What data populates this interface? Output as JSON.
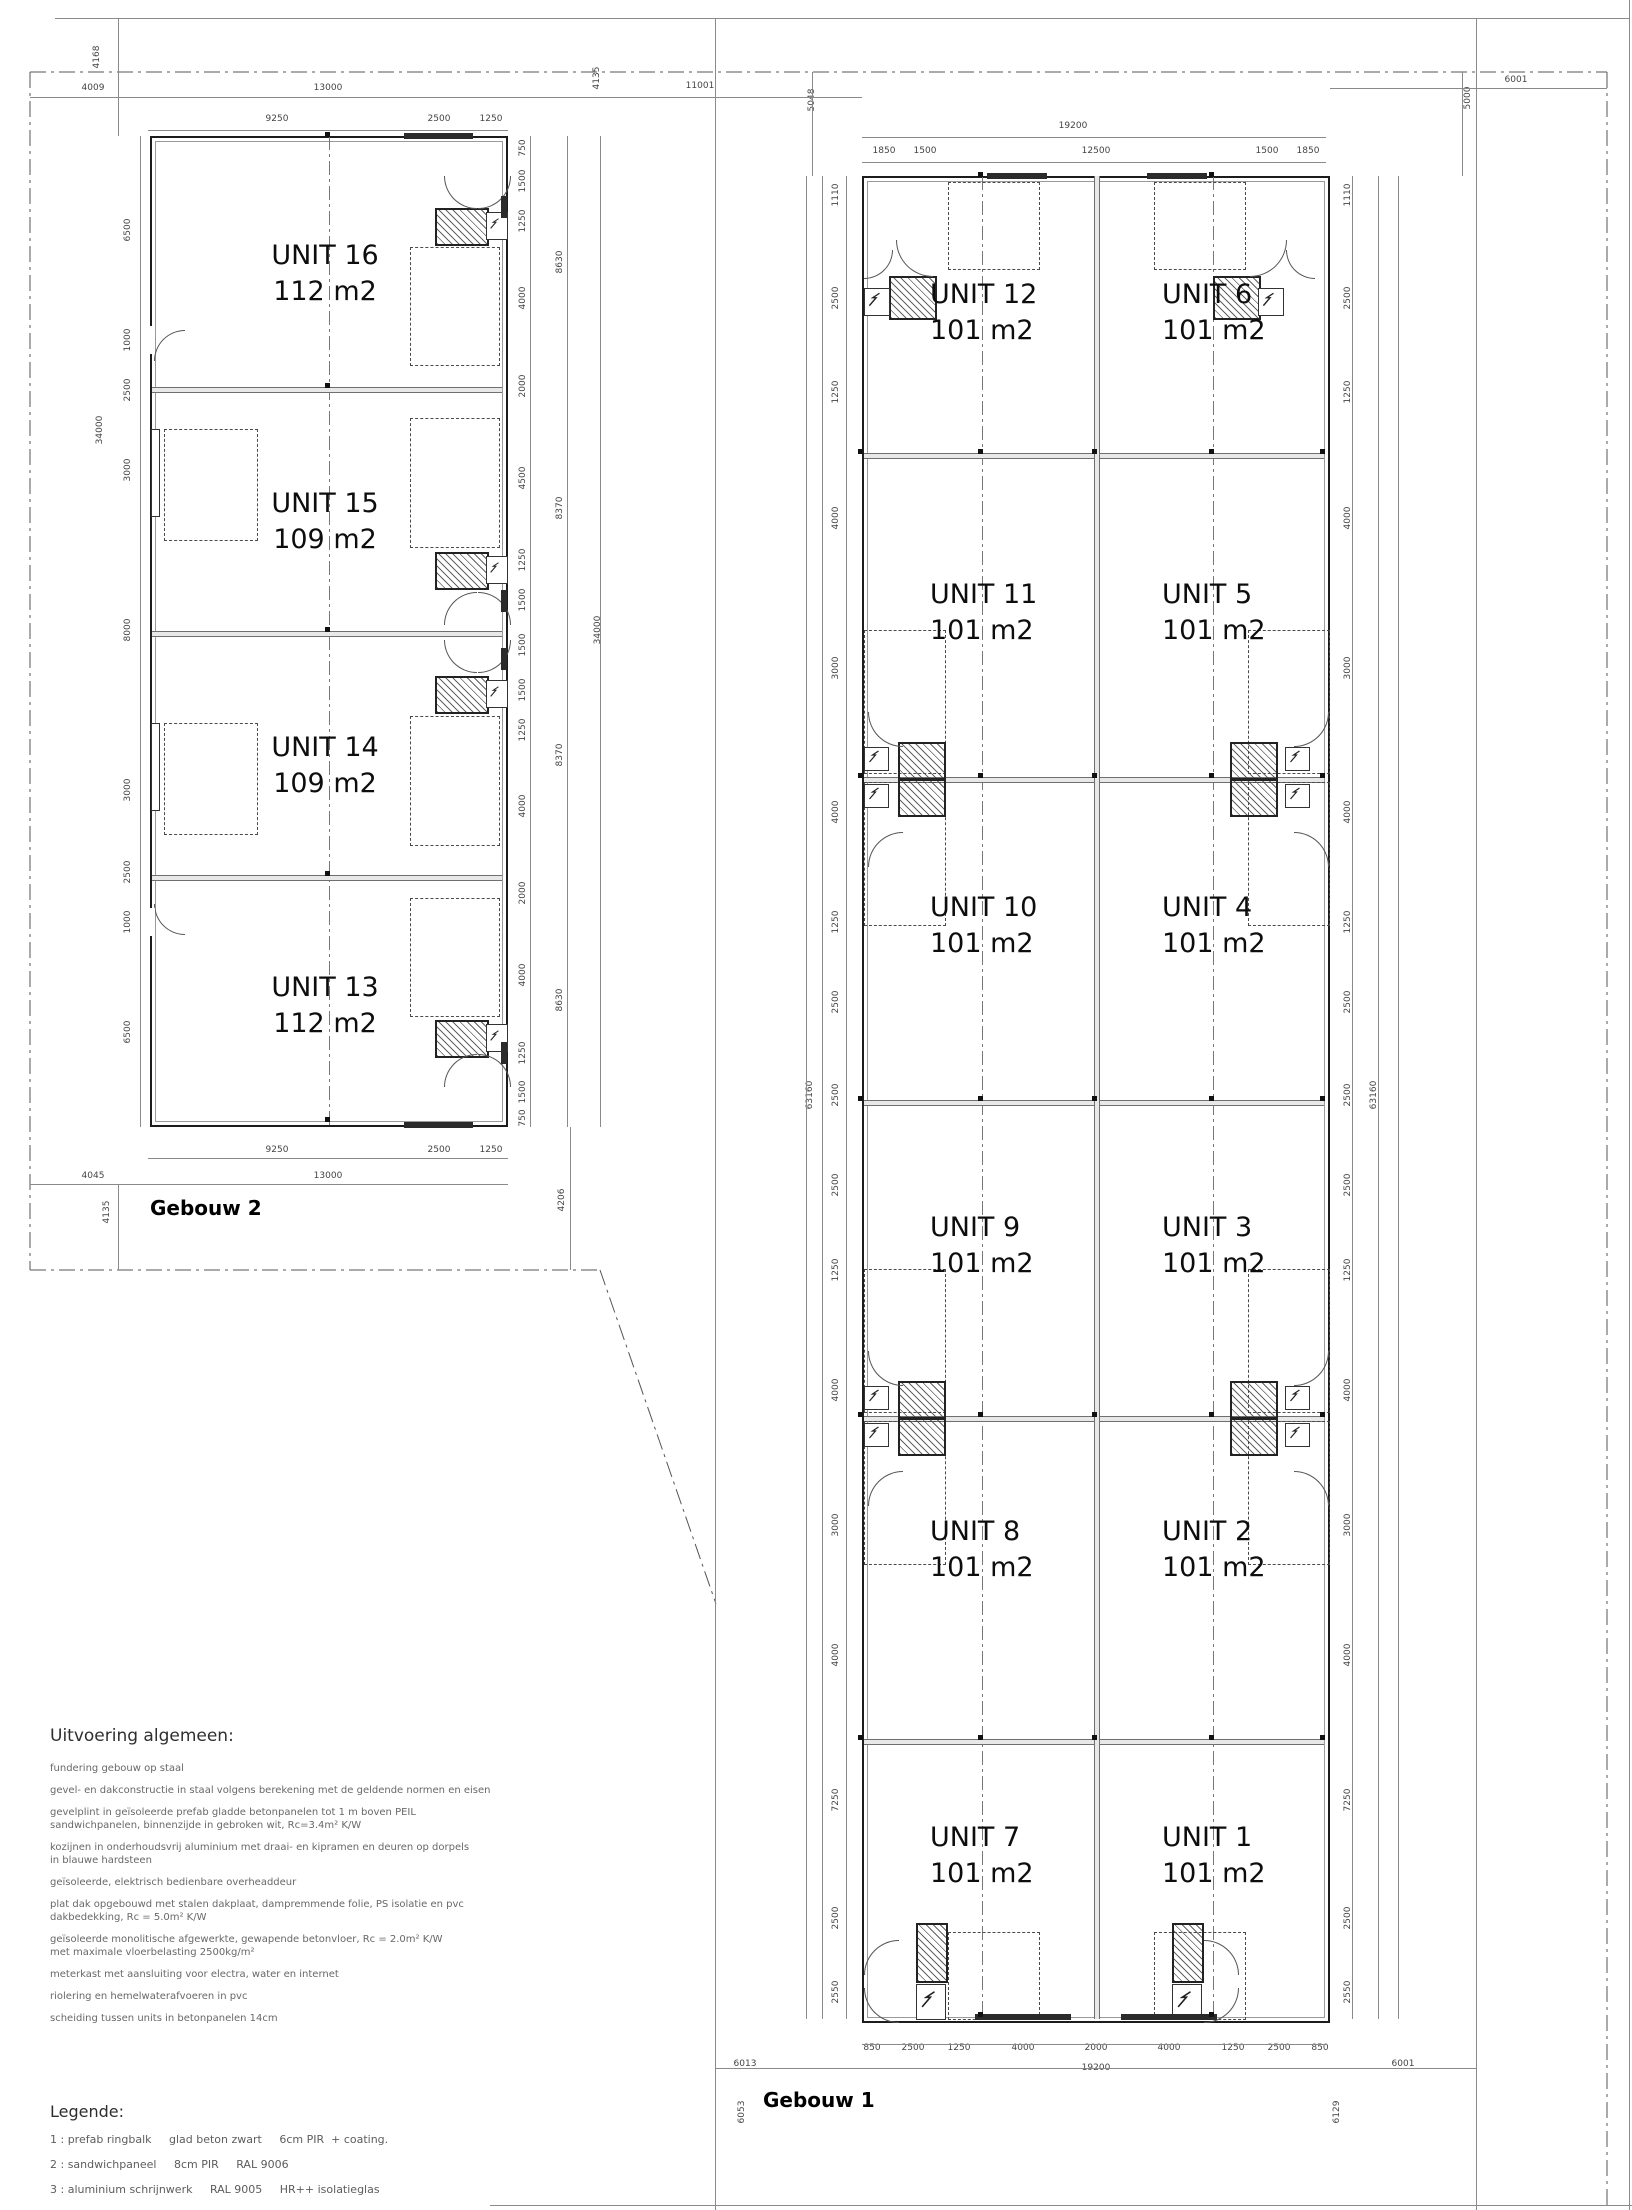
{
  "gebouw2": {
    "title": "Gebouw 2",
    "units": [
      {
        "name": "UNIT 16",
        "area": "112 m2"
      },
      {
        "name": "UNIT 15",
        "area": "109 m2"
      },
      {
        "name": "UNIT 14",
        "area": "109 m2"
      },
      {
        "name": "UNIT 13",
        "area": "112 m2"
      }
    ]
  },
  "gebouw1": {
    "title": "Gebouw 1",
    "units": [
      {
        "name": "UNIT 12",
        "area": "101 m2"
      },
      {
        "name": "UNIT 11",
        "area": "101 m2"
      },
      {
        "name": "UNIT 10",
        "area": "101 m2"
      },
      {
        "name": "UNIT 9",
        "area": "101 m2"
      },
      {
        "name": "UNIT 8",
        "area": "101 m2"
      },
      {
        "name": "UNIT 7",
        "area": "101 m2"
      },
      {
        "name": "UNIT 6",
        "area": "101 m2"
      },
      {
        "name": "UNIT 5",
        "area": "101 m2"
      },
      {
        "name": "UNIT 4",
        "area": "101 m2"
      },
      {
        "name": "UNIT 3",
        "area": "101 m2"
      },
      {
        "name": "UNIT 2",
        "area": "101 m2"
      },
      {
        "name": "UNIT 1",
        "area": "101 m2"
      }
    ]
  },
  "dims": {
    "g2_top": [
      "4009",
      "13000",
      "9250",
      "2500",
      "1250",
      "4168",
      "4135"
    ],
    "g2_left": [
      "6500",
      "1000",
      "2500",
      "3000",
      "8000",
      "3000",
      "2500",
      "1000",
      "6500",
      "34000"
    ],
    "g2_right": [
      "750",
      "1500",
      "1250",
      "4000",
      "2000",
      "4500",
      "1250",
      "1500",
      "1500",
      "1500",
      "1250",
      "4000",
      "2000",
      "4000",
      "1250",
      "1500",
      "750",
      "8630",
      "8370",
      "8370",
      "8630",
      "34000"
    ],
    "g2_bottom": [
      "9250",
      "2500",
      "1250",
      "13000",
      "4045",
      "4135",
      "4206"
    ],
    "g1_top": [
      "11001",
      "5048",
      "5000",
      "6001",
      "19200",
      "1850",
      "1500",
      "12500",
      "1500",
      "1850"
    ],
    "g1_left": [
      "1110",
      "2500",
      "1250",
      "4000",
      "3000",
      "4000",
      "1250",
      "2500",
      "2500",
      "2500",
      "1250",
      "4000",
      "3000",
      "4000",
      "7250",
      "2500",
      "2550",
      "63160"
    ],
    "g1_right": [
      "1110",
      "2500",
      "1250",
      "4000",
      "3000",
      "4000",
      "1250",
      "2500",
      "2500",
      "2500",
      "1250",
      "4000",
      "3000",
      "4000",
      "7250",
      "2500",
      "2550",
      "63160"
    ],
    "g1_bottom": [
      "850",
      "2500",
      "1250",
      "4000",
      "2000",
      "4000",
      "1250",
      "2500",
      "850",
      "19200",
      "6013",
      "6001",
      "6053",
      "6129"
    ]
  },
  "notes": {
    "heading": "Uitvoering algemeen:",
    "paragraphs": [
      "fundering gebouw op staal",
      "gevel- en dakconstructie in staal volgens berekening met de geldende normen en eisen",
      "gevelplint in geïsoleerde prefab gladde betonpanelen tot 1 m boven PEIL\nsandwichpanelen, binnenzijde in gebroken wit, Rc=3.4m² K/W",
      "kozijnen in onderhoudsvrij aluminium met draai- en kipramen en deuren op dorpels\nin blauwe hardsteen",
      "geïsoleerde, elektrisch bedienbare overheaddeur",
      "plat dak opgebouwd met stalen dakplaat, dampremmende folie, PS isolatie en pvc\ndakbedekking, Rc = 5.0m² K/W",
      "geïsoleerde monolitische afgewerkte, gewapende betonvloer, Rc = 2.0m² K/W\nmet maximale vloerbelasting 2500kg/m²",
      "meterkast met aansluiting voor electra, water en internet",
      "riolering en hemelwaterafvoeren in pvc",
      "scheiding tussen units in betonpanelen 14cm"
    ]
  },
  "legend": {
    "heading": "Legende:",
    "items": [
      "1 : prefab ringbalk     glad beton zwart     6cm PIR  + coating.",
      "2 : sandwichpaneel     8cm PIR     RAL 9006",
      "3 : aluminium schrijnwerk     RAL 9005     HR++ isolatieglas",
      "4 : sectionaalpoort     RAL 9006"
    ]
  },
  "colors": {
    "wall": "#1c1c1c",
    "thin_line": "#8a8a8a",
    "dim_text": "#444444",
    "door_band": "#2b2b2b"
  }
}
